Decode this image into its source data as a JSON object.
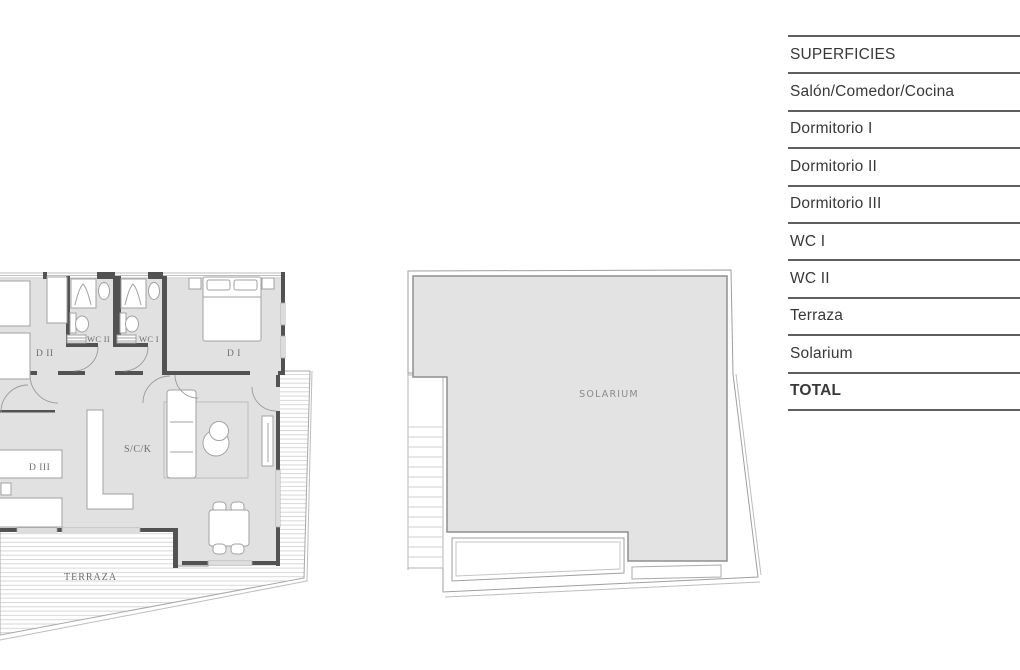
{
  "palette": {
    "wall": "#525252",
    "floor_fill": "#e1e1e1",
    "solarium_fill": "#e3e3e3",
    "furniture_outline": "#a2a2a2",
    "hatch_line": "#d7d7d7",
    "table_line": "#5e5e5e",
    "table_text": "#383838",
    "plan_label_text": "#6e6e6e"
  },
  "surfaces_table": {
    "rows": [
      "SUPERFICIES",
      "Salón/Comedor/Cocina",
      "Dormitorio I",
      "Dormitorio II",
      "Dormitorio III",
      "WC I",
      "WC II",
      "Terraza",
      "Solarium",
      "TOTAL"
    ]
  },
  "floor_plan_left": {
    "labels": {
      "dormitorio_2": "D II",
      "wc_2": "WC II",
      "wc_1": "WC I",
      "dormitorio_1": "D I",
      "dormitorio_3": "D III",
      "salon_comedor_cocina": "S/C/K",
      "terraza": "TERRAZA"
    }
  },
  "floor_plan_right": {
    "labels": {
      "solarium": "SOLARIUM"
    }
  }
}
